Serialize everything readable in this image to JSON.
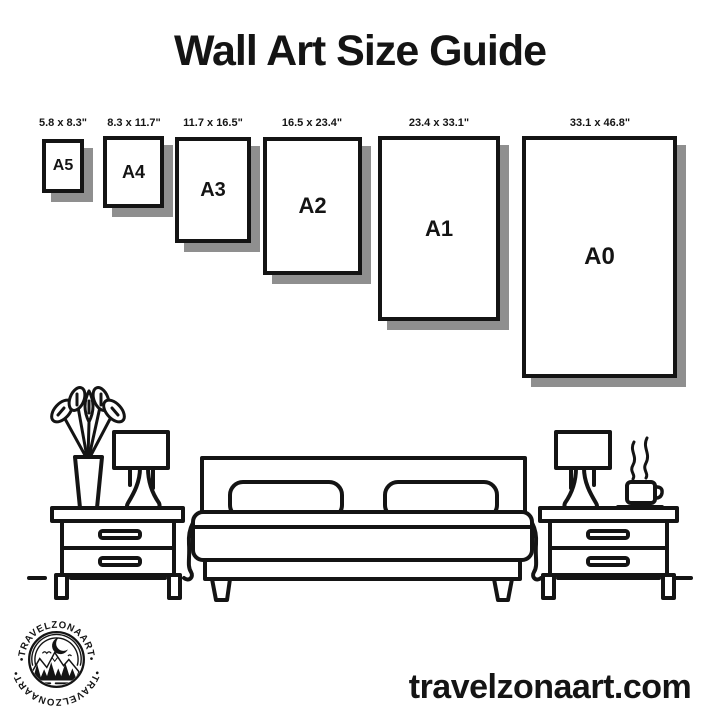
{
  "colors": {
    "background": "#ffffff",
    "ink": "#141414",
    "frame_shadow": "#8f8f8f"
  },
  "title": "Wall Art Size Guide",
  "frames": [
    {
      "name": "A5",
      "dimensions": "5.8 x 8.3\""
    },
    {
      "name": "A4",
      "dimensions": "8.3 x 11.7\""
    },
    {
      "name": "A3",
      "dimensions": "11.7 x 16.5\""
    },
    {
      "name": "A2",
      "dimensions": "16.5 x 23.4\""
    },
    {
      "name": "A1",
      "dimensions": "23.4 x 33.1\""
    },
    {
      "name": "A0",
      "dimensions": "33.1 x 46.8\""
    }
  ],
  "illustration": {
    "icons": [
      "plant-vase-icon",
      "table-lamp-icon",
      "nightstand-icon",
      "bed-icon",
      "pillow-icon",
      "coffee-cup-icon",
      "steam-icon",
      "floor-line"
    ]
  },
  "logo": {
    "ring_text_top": "•TRAVELZONAART•",
    "ring_text_bottom": "•TRAVELZONAART•",
    "icons": [
      "crescent-moon-icon",
      "birds-icon",
      "mountains-icon",
      "pine-trees-icon",
      "water-lines-icon"
    ]
  },
  "footer": {
    "website": "travelzonaart.com"
  }
}
